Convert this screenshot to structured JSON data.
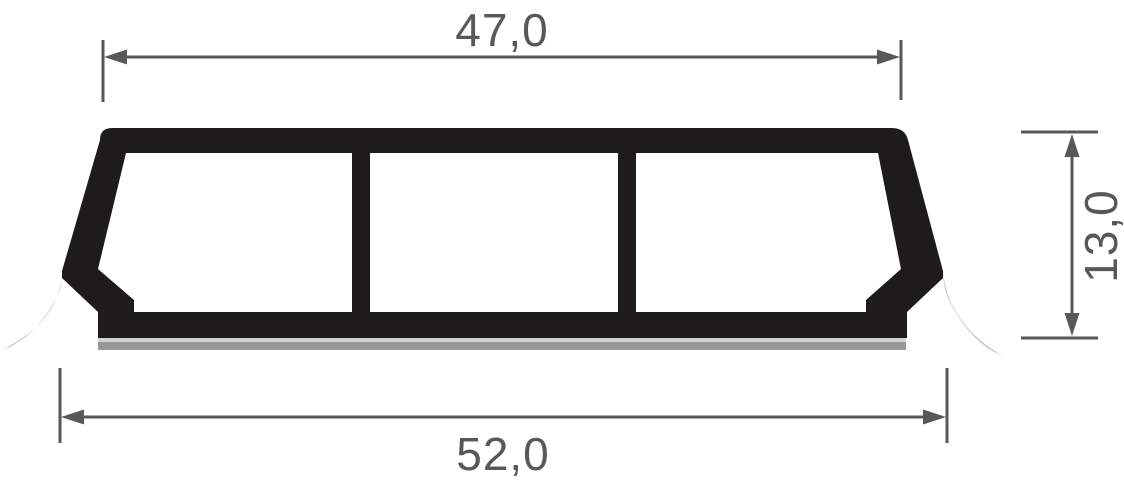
{
  "drawing": {
    "dimensions": {
      "top_width": {
        "value": "47,0"
      },
      "bottom_width": {
        "value": "52,0"
      },
      "height": {
        "value": "13,0"
      }
    },
    "colors": {
      "profile": "#1d1b1c",
      "chamber": "#ffffff",
      "dimension": "#58585a",
      "flap": "#c7c7c7",
      "tape_light": "#d3d3d3",
      "tape_dark": "#989898",
      "background": "#ffffff"
    }
  }
}
